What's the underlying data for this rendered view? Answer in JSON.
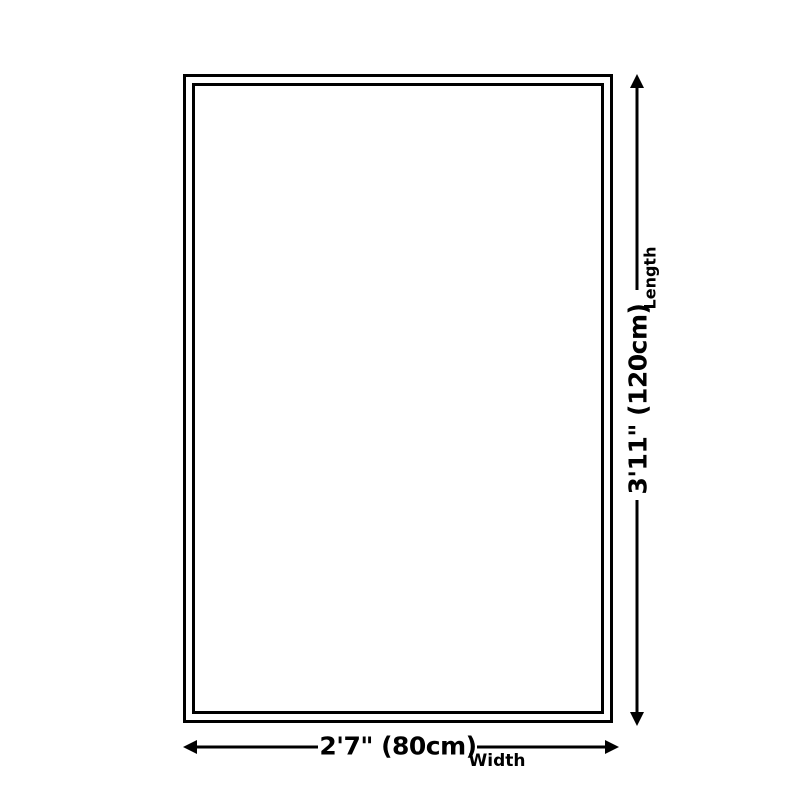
{
  "page": {
    "background_color": "#ffffff",
    "line_color": "#000000"
  },
  "diagram": {
    "type": "product-dimension-diagram",
    "shape": "double-bordered rectangle",
    "dimensions": {
      "length": {
        "value": "3'11\" (120cm)",
        "axis_label": "Length",
        "orientation": "vertical",
        "arrow": "double-headed, right side of rectangle"
      },
      "width": {
        "value": "2'7\" (80cm)",
        "axis_label": "Width",
        "orientation": "horizontal",
        "arrow": "double-headed, below rectangle"
      }
    }
  }
}
